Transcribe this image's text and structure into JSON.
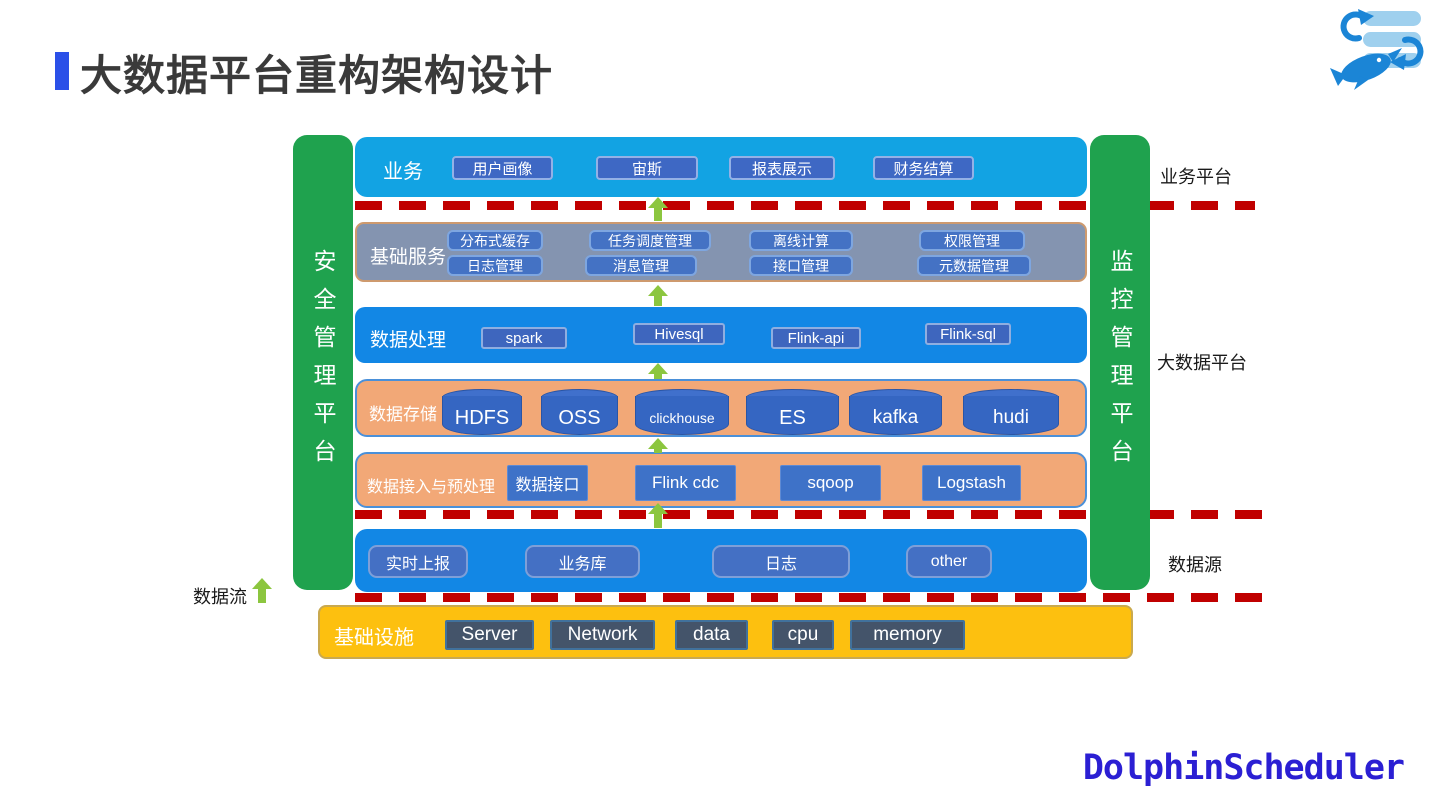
{
  "title": {
    "text": "大数据平台重构架构设计"
  },
  "brand": {
    "text": "DolphinScheduler"
  },
  "pillars": {
    "left": "安全管理平台",
    "right": "监控管理平台"
  },
  "annotations": {
    "data_flow": "数据流",
    "right_labels": {
      "business": "业务平台",
      "bigdata": "大数据平台",
      "datasource": "数据源"
    }
  },
  "business": {
    "label": "业务",
    "items": [
      "用户画像",
      "宙斯",
      "报表展示",
      "财务结算"
    ]
  },
  "services": {
    "label": "基础服务",
    "row1": [
      "分布式缓存",
      "任务调度管理",
      "离线计算",
      "权限管理"
    ],
    "row2": [
      "日志管理",
      "消息管理",
      "接口管理",
      "元数据管理"
    ]
  },
  "processing": {
    "label": "数据处理",
    "items": [
      "spark",
      "Hivesql",
      "Flink-api",
      "Flink-sql"
    ]
  },
  "storage": {
    "label": "数据存储",
    "items": [
      "HDFS",
      "OSS",
      "clickhouse",
      "ES",
      "kafka",
      "hudi"
    ]
  },
  "ingestion": {
    "label": "数据接入与预处理",
    "items": [
      "数据接口",
      "Flink cdc",
      "sqoop",
      "Logstash"
    ]
  },
  "sources": {
    "items": [
      "实时上报",
      "业务库",
      "日志",
      "other"
    ]
  },
  "infrastructure": {
    "label": "基础设施",
    "items": [
      "Server",
      "Network",
      "data",
      "cpu",
      "memory"
    ]
  },
  "icons": {
    "logo": "dolphinscheduler-logo",
    "arrow": "up-arrow-icon"
  },
  "colors": {
    "accent_blue": "#2B50E8",
    "layer_cyan": "#12A3E3",
    "layer_blue": "#1287E5",
    "layer_gray": "#8494B0",
    "layer_peach": "#F2A877",
    "layer_yellow": "#FDC00F",
    "pillar_green": "#1FA24E",
    "dashed_red": "#C00000",
    "arrow_green": "#8CC63F",
    "button_blue": "#4472C4",
    "infra_slate": "#44546A",
    "brand_blue": "#2B1FD3",
    "title_gray": "#3A3A3A"
  }
}
